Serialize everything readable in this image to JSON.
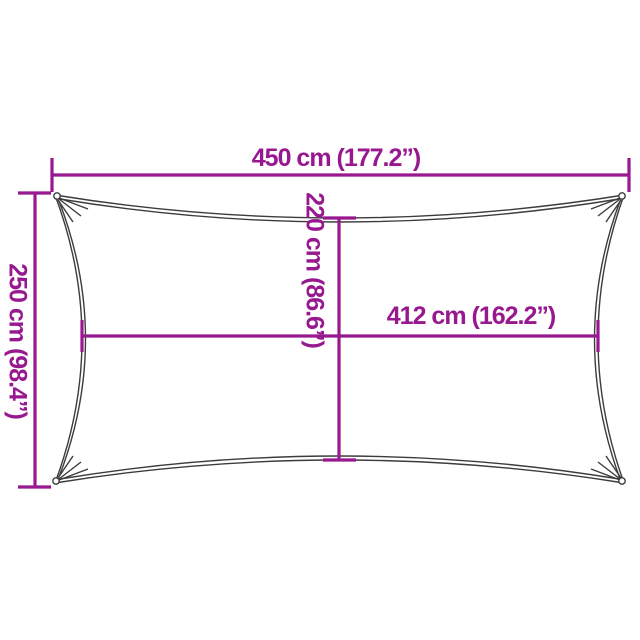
{
  "diagram": {
    "type": "shade-sail-dimension-diagram",
    "labels": {
      "width": "450 cm (177.2”)",
      "height": "250 cm (98.4”)",
      "inner_height": "220 cm (86.6”)",
      "inner_width": "412 cm (162.2”)"
    },
    "dimensions": {
      "width_cm": 450,
      "width_in": 177.2,
      "height_cm": 250,
      "height_in": 98.4,
      "inner_height_cm": 220,
      "inner_height_in": 86.6,
      "inner_width_cm": 412,
      "inner_width_in": 162.2
    },
    "colors": {
      "dimension_line": "#97188F",
      "sail_outline": "#3C3C3C",
      "background": "#FFFFFF"
    }
  }
}
